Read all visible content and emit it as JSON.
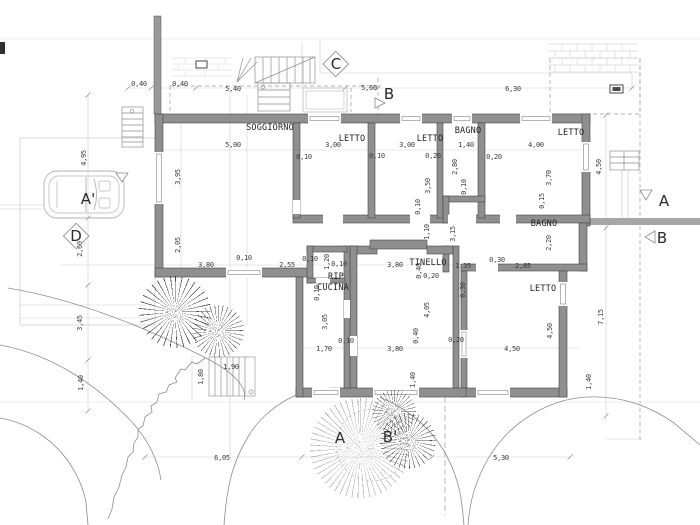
{
  "colors": {
    "wall_fill": "#8f8f8f",
    "wall_outline": "#474747",
    "section_band": "#a6a6a6",
    "dim_text": "#3b3b3b",
    "construction_line": "#cfcfcf"
  },
  "rooms": [
    {
      "t": "SOGGIORNO",
      "x": 270,
      "y": 128
    },
    {
      "t": "LETTO",
      "x": 352,
      "y": 139
    },
    {
      "t": "LETTO",
      "x": 430,
      "y": 139
    },
    {
      "t": "BAGNO",
      "x": 468,
      "y": 131
    },
    {
      "t": "LETTO",
      "x": 571,
      "y": 133
    },
    {
      "t": "BAGNO",
      "x": 544,
      "y": 224
    },
    {
      "t": "TINELLO",
      "x": 428,
      "y": 263
    },
    {
      "t": "RIP",
      "x": 336,
      "y": 277
    },
    {
      "t": "CUCINA",
      "x": 333,
      "y": 288
    },
    {
      "t": "LETTO",
      "x": 543,
      "y": 289
    }
  ],
  "markers": [
    {
      "t": "C",
      "x": 336,
      "y": 64,
      "cls": "diamond"
    },
    {
      "t": "B",
      "x": 389,
      "y": 94
    },
    {
      "t": "A",
      "x": 664,
      "y": 201
    },
    {
      "t": "B",
      "x": 662,
      "y": 238
    },
    {
      "t": "A'",
      "x": 88,
      "y": 199
    },
    {
      "t": "D",
      "x": 76,
      "y": 236,
      "cls": "diamond"
    },
    {
      "t": "A",
      "x": 340,
      "y": 438
    },
    {
      "t": "B'",
      "x": 390,
      "y": 437
    }
  ],
  "dims": [
    {
      "t": "0,40",
      "x": 139,
      "y": 84
    },
    {
      "t": "0,40",
      "x": 180,
      "y": 84
    },
    {
      "t": "5,40",
      "x": 233,
      "y": 89
    },
    {
      "t": "5,60",
      "x": 369,
      "y": 88
    },
    {
      "t": "6,30",
      "x": 513,
      "y": 89
    },
    {
      "t": "4,95",
      "x": 84,
      "y": 158,
      "v": 1
    },
    {
      "t": "2,60",
      "x": 80,
      "y": 249,
      "v": 1
    },
    {
      "t": "3,45",
      "x": 80,
      "y": 323,
      "v": 1
    },
    {
      "t": "1,40",
      "x": 81,
      "y": 383,
      "v": 1
    },
    {
      "t": "4,50",
      "x": 599,
      "y": 167,
      "v": 1
    },
    {
      "t": "7,15",
      "x": 601,
      "y": 317,
      "v": 1
    },
    {
      "t": "6,05",
      "x": 222,
      "y": 458
    },
    {
      "t": "5,30",
      "x": 501,
      "y": 458
    },
    {
      "t": "1,80",
      "x": 201,
      "y": 377,
      "v": 1
    },
    {
      "t": "1,90",
      "x": 231,
      "y": 367
    },
    {
      "t": "5,00",
      "x": 233,
      "y": 145
    },
    {
      "t": "3,95",
      "x": 178,
      "y": 177,
      "v": 1
    },
    {
      "t": "2,05",
      "x": 178,
      "y": 245,
      "v": 1
    },
    {
      "t": "0,10",
      "x": 304,
      "y": 157
    },
    {
      "t": "3,00",
      "x": 333,
      "y": 145
    },
    {
      "t": "0,10",
      "x": 377,
      "y": 156
    },
    {
      "t": "3,00",
      "x": 407,
      "y": 145
    },
    {
      "t": "0,20",
      "x": 433,
      "y": 156
    },
    {
      "t": "3,50",
      "x": 428,
      "y": 186,
      "v": 1
    },
    {
      "t": "1,40",
      "x": 466,
      "y": 145
    },
    {
      "t": "2,80",
      "x": 455,
      "y": 167,
      "v": 1
    },
    {
      "t": "0,10",
      "x": 464,
      "y": 187,
      "v": 1
    },
    {
      "t": "0,20",
      "x": 494,
      "y": 157
    },
    {
      "t": "4,00",
      "x": 536,
      "y": 145
    },
    {
      "t": "3,70",
      "x": 549,
      "y": 178,
      "v": 1
    },
    {
      "t": "0,15",
      "x": 542,
      "y": 201,
      "v": 1
    },
    {
      "t": "0,10",
      "x": 418,
      "y": 207,
      "v": 1
    },
    {
      "t": "1,10",
      "x": 427,
      "y": 232,
      "v": 1
    },
    {
      "t": "3,15",
      "x": 453,
      "y": 234,
      "v": 1
    },
    {
      "t": "0,10",
      "x": 244,
      "y": 258
    },
    {
      "t": "3,80",
      "x": 206,
      "y": 265
    },
    {
      "t": "2,55",
      "x": 287,
      "y": 265
    },
    {
      "t": "0,10",
      "x": 310,
      "y": 259
    },
    {
      "t": "1,20",
      "x": 327,
      "y": 262,
      "v": 1
    },
    {
      "t": "0,10",
      "x": 339,
      "y": 264
    },
    {
      "t": "3,80",
      "x": 395,
      "y": 265
    },
    {
      "t": "0,40",
      "x": 419,
      "y": 271,
      "v": 1
    },
    {
      "t": "0,20",
      "x": 431,
      "y": 276
    },
    {
      "t": "1,35",
      "x": 463,
      "y": 266
    },
    {
      "t": "0,30",
      "x": 497,
      "y": 260
    },
    {
      "t": "2,85",
      "x": 523,
      "y": 266
    },
    {
      "t": "2,20",
      "x": 549,
      "y": 243,
      "v": 1
    },
    {
      "t": "0,30",
      "x": 463,
      "y": 290,
      "v": 1
    },
    {
      "t": "0,10",
      "x": 317,
      "y": 293,
      "v": 1
    },
    {
      "t": "3,05",
      "x": 325,
      "y": 322,
      "v": 1
    },
    {
      "t": "0,10",
      "x": 346,
      "y": 341
    },
    {
      "t": "1,70",
      "x": 324,
      "y": 349
    },
    {
      "t": "3,80",
      "x": 395,
      "y": 349
    },
    {
      "t": "4,05",
      "x": 427,
      "y": 310,
      "v": 1
    },
    {
      "t": "0,40",
      "x": 416,
      "y": 336,
      "v": 1
    },
    {
      "t": "0,20",
      "x": 456,
      "y": 340
    },
    {
      "t": "4,50",
      "x": 512,
      "y": 349
    },
    {
      "t": "4,50",
      "x": 550,
      "y": 331,
      "v": 1
    },
    {
      "t": "1,40",
      "x": 413,
      "y": 380,
      "v": 1
    },
    {
      "t": "1,40",
      "x": 589,
      "y": 382,
      "v": 1
    }
  ],
  "plants": [
    {
      "x": 175,
      "y": 312,
      "d": 72
    },
    {
      "x": 218,
      "y": 331,
      "d": 52
    },
    {
      "x": 360,
      "y": 448,
      "d": 100,
      "cls": "light"
    },
    {
      "x": 394,
      "y": 412,
      "d": 44
    },
    {
      "x": 408,
      "y": 441,
      "d": 56
    }
  ]
}
